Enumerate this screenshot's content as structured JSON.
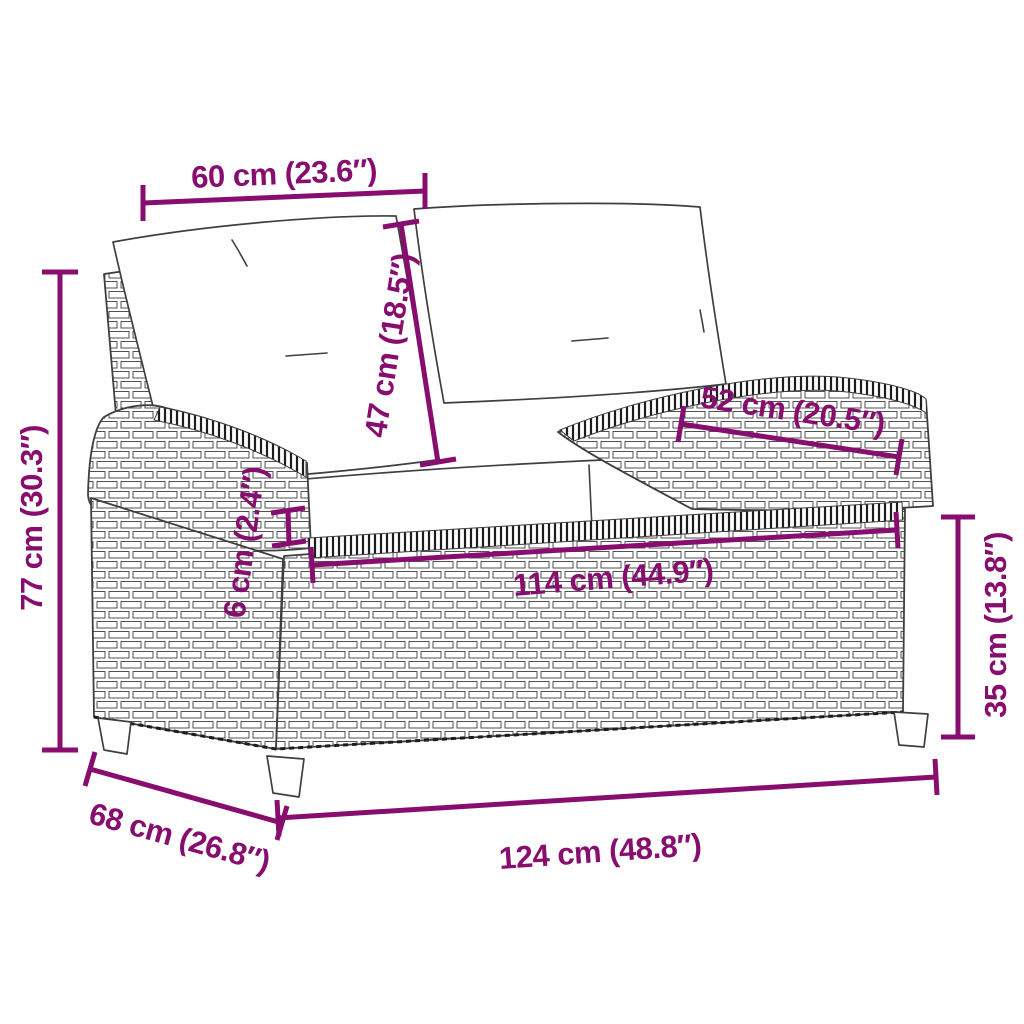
{
  "diagram": {
    "description": "Line drawing of a two-seater poly rattan garden bench with back and seat cushions, annotated with product measurements",
    "colors": {
      "accent": "#870d6e",
      "line": "#3f3f3f",
      "weave": "#1d1d1d",
      "background": "#ffffff"
    },
    "dimensions": [
      {
        "id": "backrest-cushion-width",
        "label": "60 cm (23.6″)"
      },
      {
        "id": "backrest-cushion-height",
        "label": "47 cm (18.5″)"
      },
      {
        "id": "armrest-length",
        "label": "52 cm (20.5″)"
      },
      {
        "id": "seat-cushion-thickness",
        "label": "6 cm (2.4″)"
      },
      {
        "id": "total-height",
        "label": "77 cm (30.3″)"
      },
      {
        "id": "seat-width",
        "label": "114 cm (44.9″)"
      },
      {
        "id": "base-height",
        "label": "35 cm (13.8″)"
      },
      {
        "id": "depth",
        "label": "68 cm (26.8″)"
      },
      {
        "id": "total-width",
        "label": "124 cm (48.8″)"
      }
    ]
  }
}
